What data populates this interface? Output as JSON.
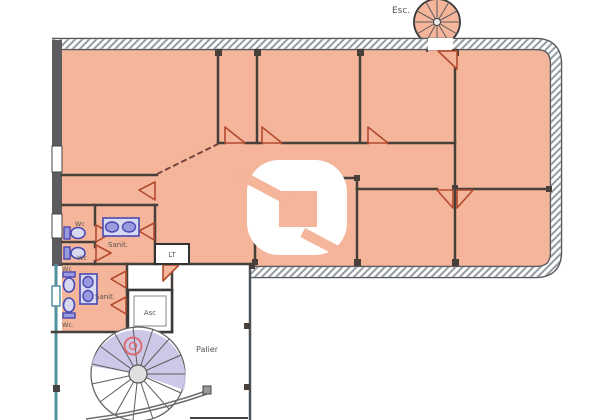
{
  "plan": {
    "labels": {
      "esc": "Esc.",
      "wc_upper_1": "Wc",
      "wc_upper_2": "Wc",
      "sanit_upper": "Sanit.",
      "lt": "LT",
      "wc_lower_1": "Wc",
      "wc_lower_2": "Wc.",
      "sanit_lower": "Sanit.",
      "asc": "Asc",
      "palier": "Palier"
    }
  },
  "colors": {
    "floor": "#f4b59b",
    "wall": "#47403a",
    "door": "#b34a2e",
    "fixture": "#4949b4",
    "fixture_light": "#d9d9f2",
    "stair": "#c9c2e6",
    "teal": "#53909e",
    "marker": "#dd5f5f",
    "hatch": "#949ba1"
  }
}
